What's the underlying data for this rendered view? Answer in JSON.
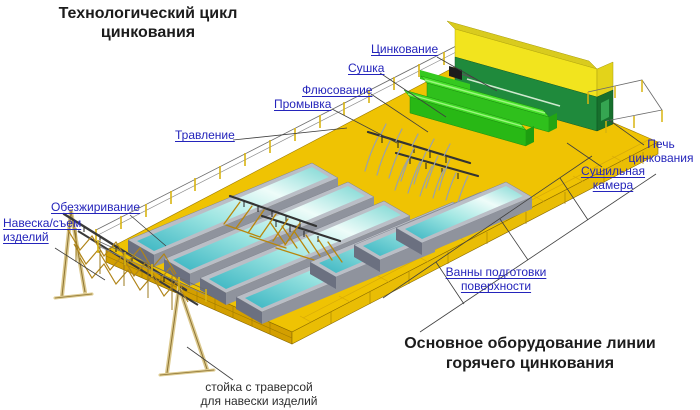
{
  "diagram": {
    "title": "Технологический цикл цинкования",
    "footer_title": "Основное оборудование линии горячего цинкования",
    "stand_caption": "стойка с траверсой для навески изделий",
    "labels": {
      "zinc": "Цинкование",
      "drying": "Сушка",
      "fluxing": "Флюсование",
      "rinsing": "Промывка",
      "pickling": "Травление",
      "degreasing": "Обезжиривание",
      "loading": "Навеска/съем изделий",
      "furnace": "Печь цинкования",
      "drying_chamber": "Сушильная камера",
      "prep_baths": "Ванны подготовки поверхности"
    },
    "colors": {
      "label_blue": "#2424bb",
      "platform_gold": "#efc303",
      "apron_dark_gold": "#d39f00",
      "furnace_roof_yellow": "#f2e41e",
      "furnace_wall_green": "#1f8a3c",
      "dryer_green": "#3fd926",
      "bath_liquid_teal": "#3ab5c2",
      "bath_rim_gray": "#babec6",
      "articles_gold": "#b8860b",
      "pipes_gray": "#9aa1ab"
    }
  }
}
